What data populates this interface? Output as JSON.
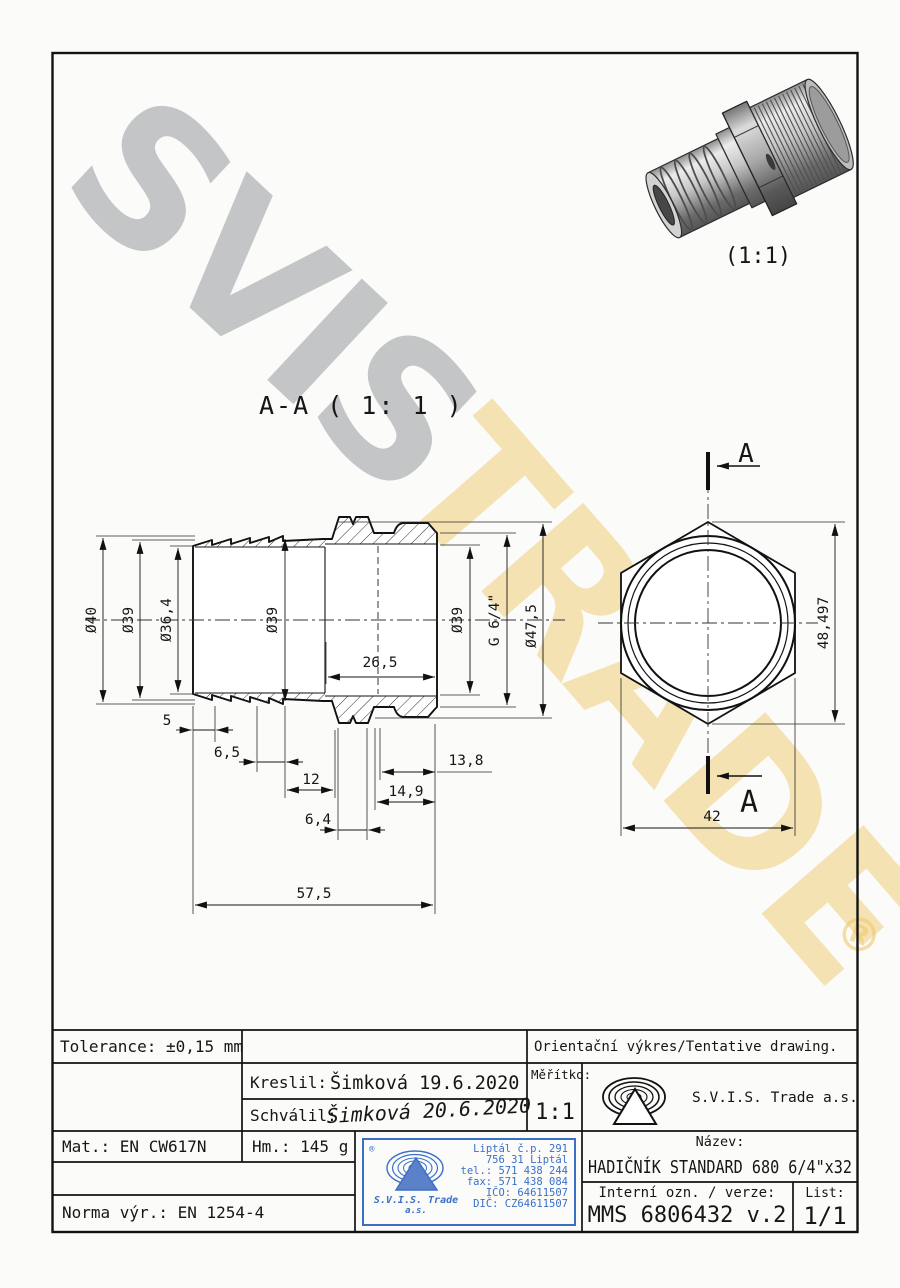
{
  "watermark": {
    "primary": "SVIS",
    "secondary": "TRADE",
    "registered": "®"
  },
  "pictorial": {
    "scale": "(1:1)"
  },
  "section": {
    "label": "A-A ( 1: 1 )",
    "dims": {
      "d40": "Ø40",
      "d39_left": "Ø39",
      "d36_4": "Ø36,4",
      "d39_mid": "Ø39",
      "d39_right": "Ø39",
      "g64": "G 6/4\"",
      "d47_5": "Ø47,5",
      "len26_5": "26,5",
      "len5": "5",
      "len6_5": "6,5",
      "len12": "12",
      "len13_8": "13,8",
      "len14_9": "14,9",
      "len6_4": "6,4",
      "len57_5": "57,5"
    }
  },
  "end_view": {
    "cut_label_top": "A",
    "cut_label_bottom": "A",
    "dim_across_corners": "48,497",
    "dim_across_flats": "42"
  },
  "title_block": {
    "tolerance": "Tolerance: ±0,15 mm",
    "orientation_note": "Orientační výkres/Tentative drawing.",
    "drawn_label": "Kreslil:",
    "drawn_value": "Šimková 19.6.2020",
    "approved_label": "Schválil:",
    "approved_signature": "Šimková 20.6.2020",
    "scale_label": "Měřítko:",
    "scale_value": "1:1",
    "company": "S.V.I.S. Trade a.s.",
    "material": "Mat.: EN CW617N",
    "mass": "Hm.: 145 g",
    "title_label": "Název:",
    "title_value": "HADIČNÍK STANDARD 680 6/4\"x32",
    "internal_label": "Interní ozn. / verze:",
    "internal_value": "MMS 6806432 v.2",
    "sheet_label": "List:",
    "sheet_value": "1/1",
    "standard": "Norma výr.: EN 1254-4",
    "stamp": {
      "registered": "®",
      "name_line1": "S.V.I.S. Trade",
      "name_line2": "a.s.",
      "lines": [
        "Liptál č.p. 291",
        "756 31 Liptál",
        "tel.: 571 438 244",
        "fax: 571 438 084",
        "IČO: 64611507",
        "DIČ: CZ64611507"
      ]
    }
  },
  "colors": {
    "stamp_blue": "#3b6fc7",
    "signature_blue": "#3f51a8",
    "watermark_gray": "rgba(140,143,148,0.50)",
    "watermark_gold": "rgba(236,191,80,0.42)",
    "line": "#161616"
  }
}
